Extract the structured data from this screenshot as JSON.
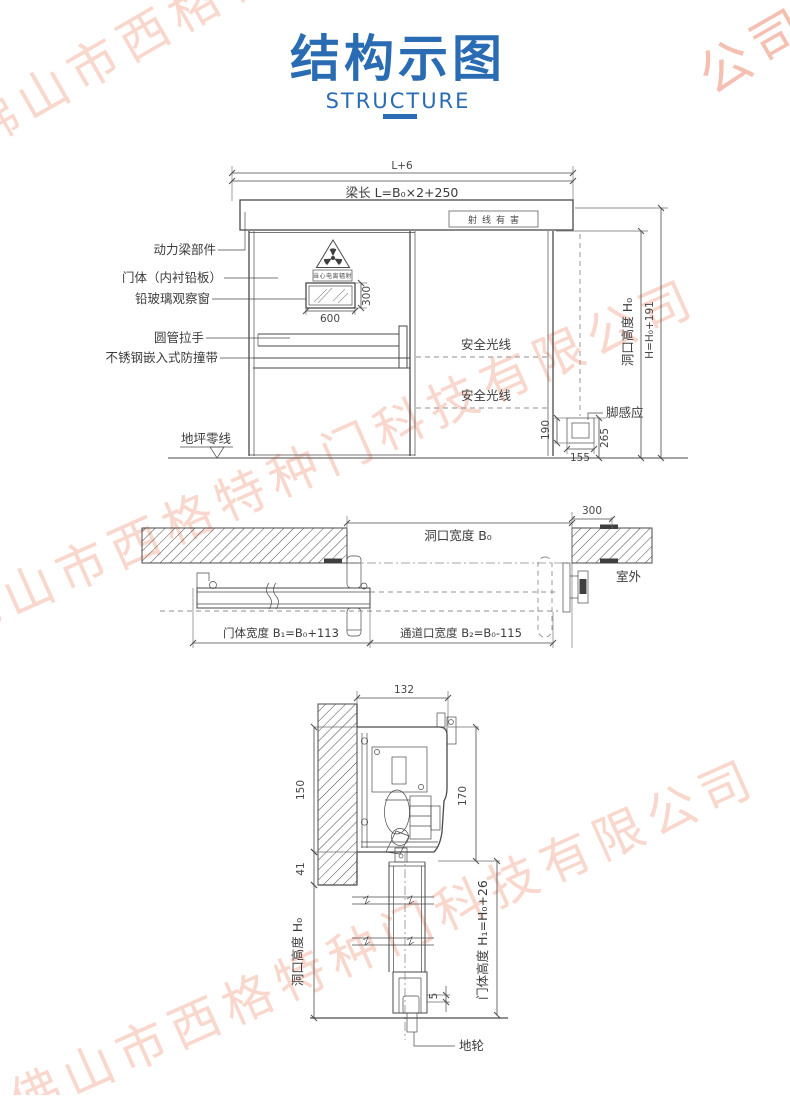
{
  "watermark": {
    "company": "佛山市西格特种门科技有限公司",
    "partial": "公司",
    "color": "#f0997a"
  },
  "header": {
    "title": "结构示图",
    "subtitle": "STRUCTURE",
    "accent_color": "#2a6cb3"
  },
  "front_view": {
    "dim_overall": "L+6",
    "dim_beam": "梁长 L=B₀×2+250",
    "radiation_sign": "射线有害",
    "warning_caption": "当心电离辐射",
    "label_power_beam": "动力梁部件",
    "label_door_body": "门体（内衬铅板）",
    "label_lead_glass": "铅玻璃观察窗",
    "label_handle": "圆管拉手",
    "label_bumper": "不锈钢嵌入式防撞带",
    "label_ground_zero": "地坪零线",
    "label_safety_beam_upper": "安全光线",
    "label_safety_beam_lower": "安全光线",
    "label_foot_sensor": "脚感应",
    "window_width": "600",
    "window_height": "300",
    "sensor_height": "190",
    "sensor_width": "155",
    "sensor_elevation": "265",
    "dim_opening_height": "洞口高度 H₀",
    "dim_total_height": "H=H₀+191"
  },
  "plan_view": {
    "dim_wall": "300",
    "dim_opening_width": "洞口宽度 B₀",
    "label_outdoor": "室外",
    "dim_door_width": "门体宽度 B₁=B₀+113",
    "dim_passage_width": "通道口宽度 B₂=B₀-115"
  },
  "section_view": {
    "dim_width": "132",
    "dim_housing_height": "150",
    "dim_track_height": "170",
    "dim_lintel_gap": "41",
    "dim_floor_gap": "5",
    "dim_opening_height": "洞口高度 H₀",
    "dim_door_height": "门体高度 H₁=H₀+26",
    "label_floor_wheel": "地轮"
  }
}
